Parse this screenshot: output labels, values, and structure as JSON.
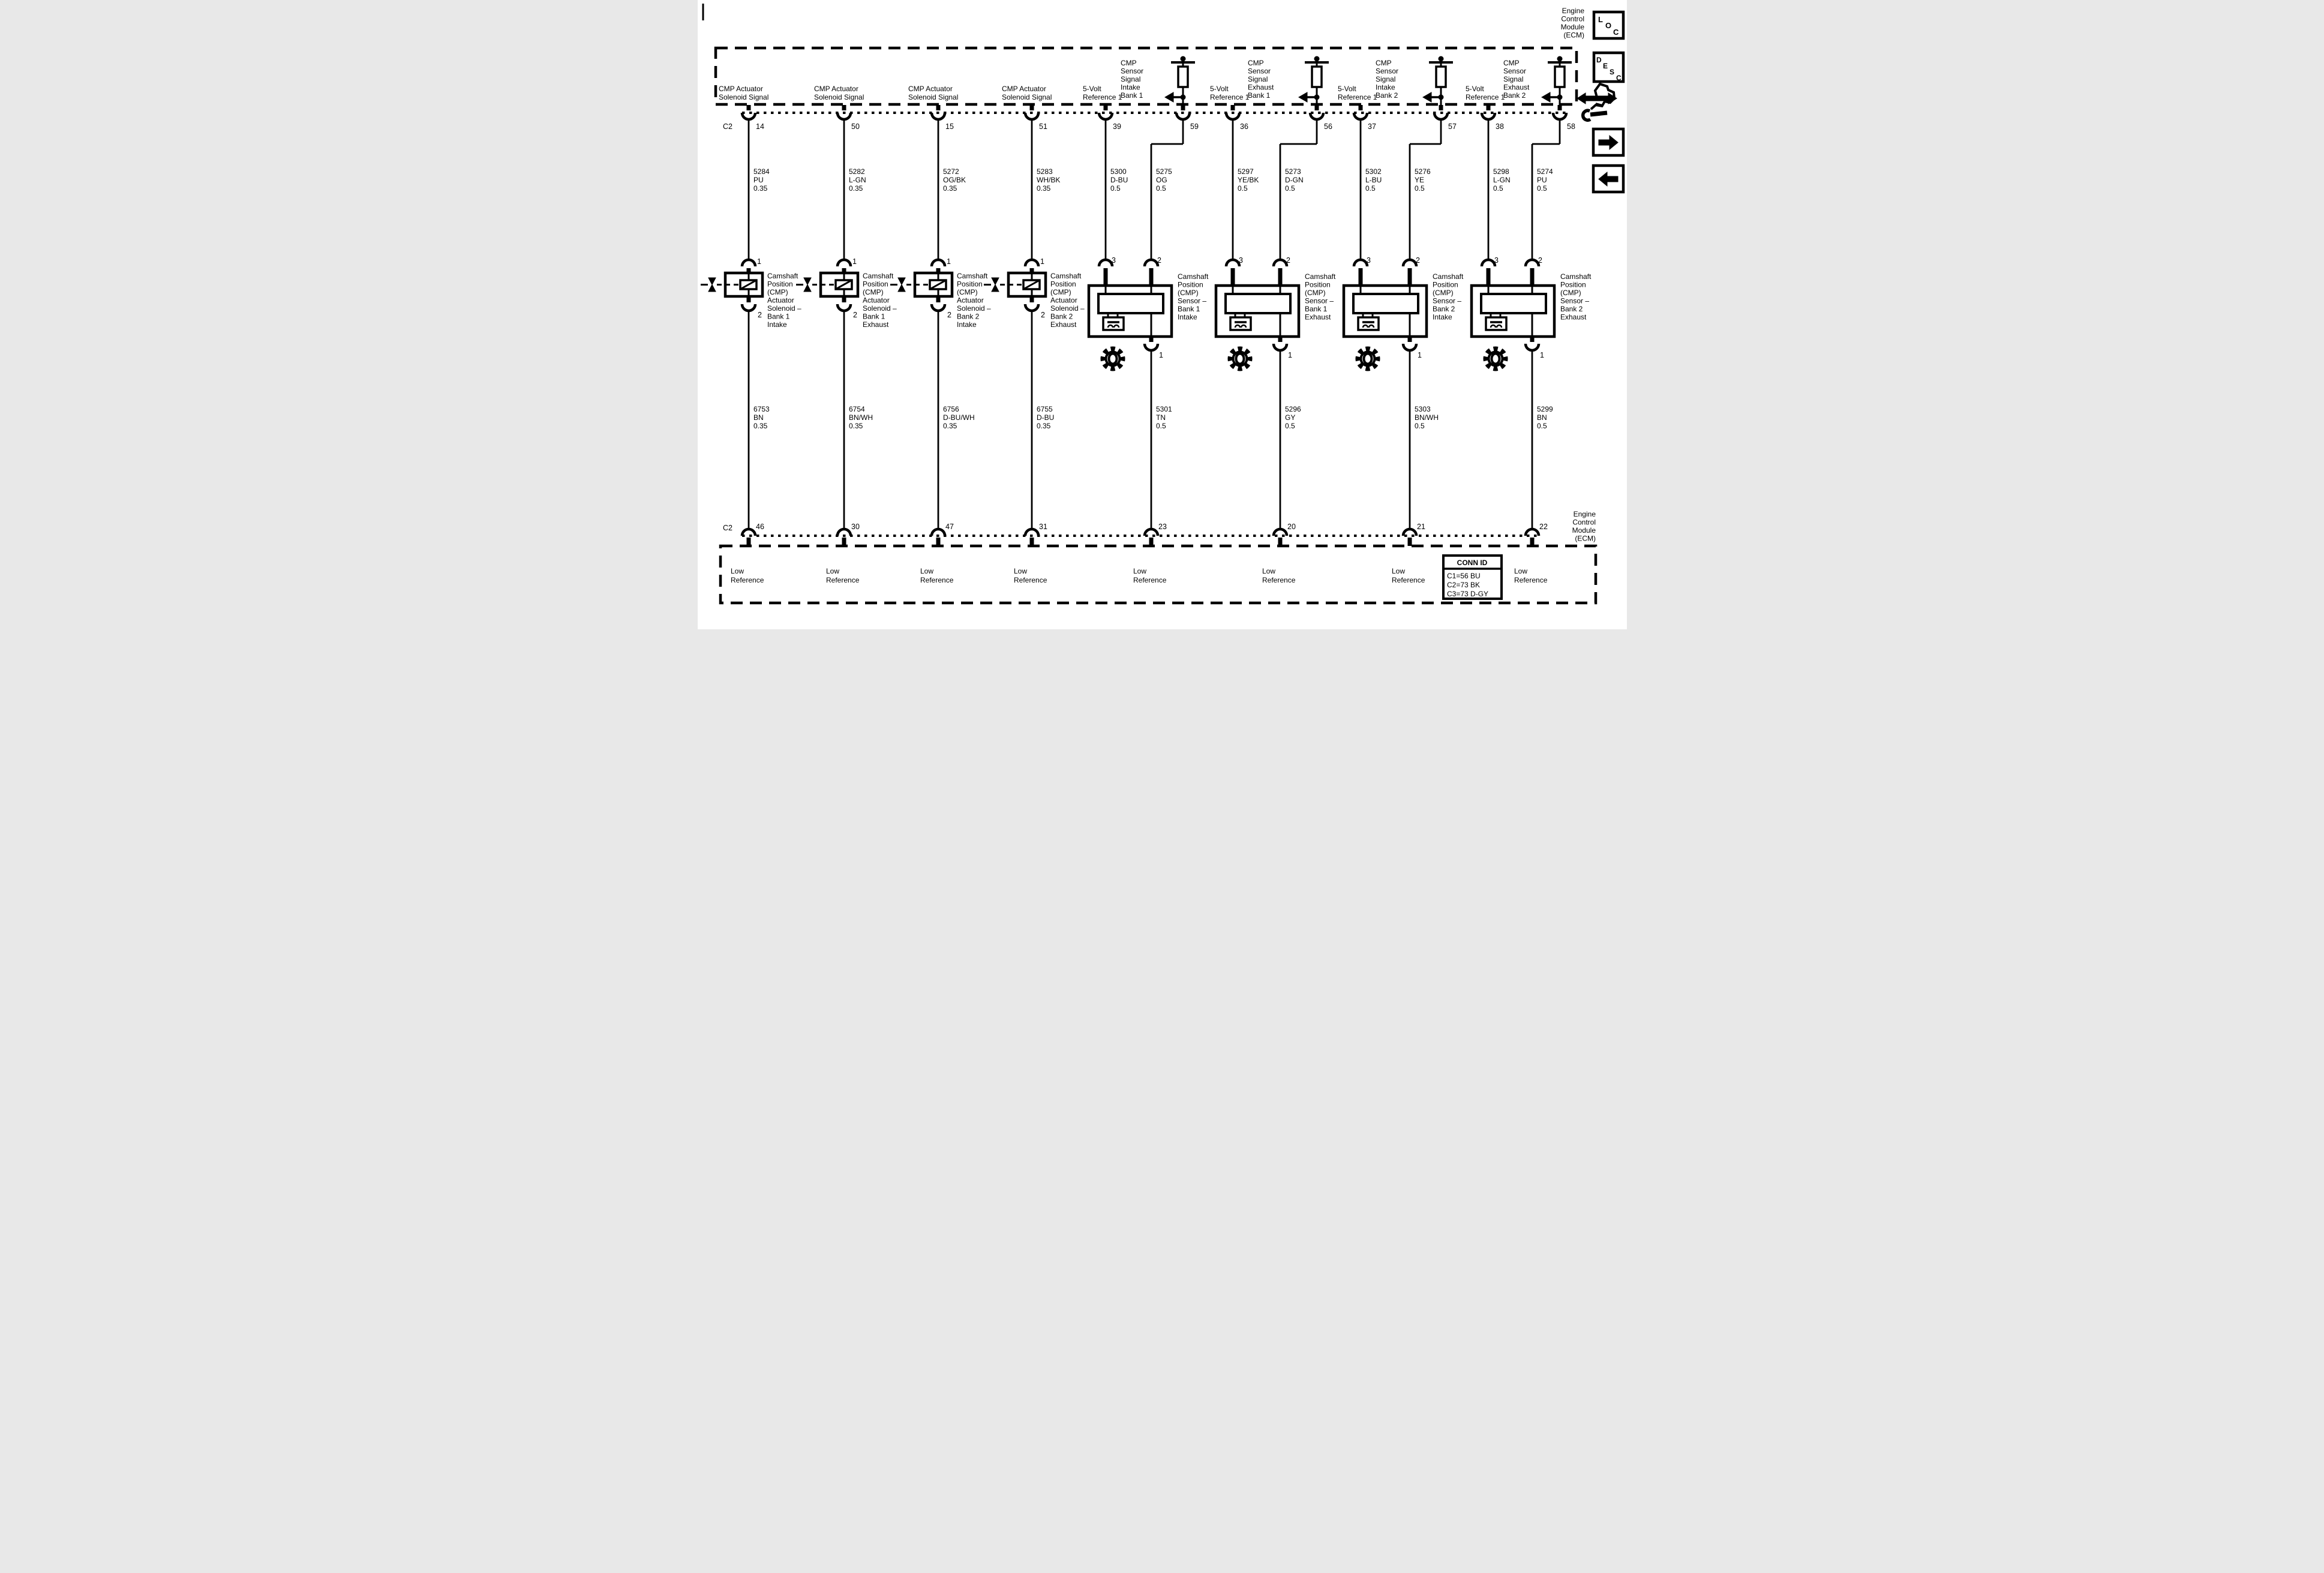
{
  "ecm": {
    "connector_id": "C2",
    "top_label": [
      "Engine",
      "Control",
      "Module",
      "(ECM)"
    ],
    "bottom_label": [
      "Engine",
      "Control",
      "Module",
      "(ECM)"
    ]
  },
  "icons": {
    "loc": [
      "L",
      "O",
      "C"
    ],
    "desc": [
      "D",
      "E",
      "S",
      "C"
    ]
  },
  "conn_id": {
    "title": "CONN ID",
    "rows": [
      "C1=56 BU",
      "C2=73 BK",
      "C3=73 D-GY"
    ]
  },
  "low_reference": [
    "Low",
    "Reference"
  ],
  "actuators": [
    {
      "signal_label": [
        "CMP Actuator",
        "Solenoid Signal"
      ],
      "pin_top": "14",
      "wire_top": [
        "5284",
        "PU",
        "0.35"
      ],
      "dev_pin_top": "1",
      "dev_pin_bottom": "2",
      "device": [
        "Camshaft",
        "Position",
        "(CMP)",
        "Actuator",
        "Solenoid –",
        "Bank 1",
        "Intake"
      ],
      "wire_bottom": [
        "6753",
        "BN",
        "0.35"
      ],
      "pin_bottom": "46"
    },
    {
      "signal_label": [
        "CMP Actuator",
        "Solenoid Signal"
      ],
      "pin_top": "50",
      "wire_top": [
        "5282",
        "L-GN",
        "0.35"
      ],
      "dev_pin_top": "1",
      "dev_pin_bottom": "2",
      "device": [
        "Camshaft",
        "Position",
        "(CMP)",
        "Actuator",
        "Solenoid –",
        "Bank 1",
        "Exhaust"
      ],
      "wire_bottom": [
        "6754",
        "BN/WH",
        "0.35"
      ],
      "pin_bottom": "30"
    },
    {
      "signal_label": [
        "CMP Actuator",
        "Solenoid Signal"
      ],
      "pin_top": "15",
      "wire_top": [
        "5272",
        "OG/BK",
        "0.35"
      ],
      "dev_pin_top": "1",
      "dev_pin_bottom": "2",
      "device": [
        "Camshaft",
        "Position",
        "(CMP)",
        "Actuator",
        "Solenoid –",
        "Bank 2",
        "Intake"
      ],
      "wire_bottom": [
        "6756",
        "D-BU/WH",
        "0.35"
      ],
      "pin_bottom": "47"
    },
    {
      "signal_label": [
        "CMP Actuator",
        "Solenoid Signal"
      ],
      "pin_top": "51",
      "wire_top": [
        "5283",
        "WH/BK",
        "0.35"
      ],
      "dev_pin_top": "1",
      "dev_pin_bottom": "2",
      "device": [
        "Camshaft",
        "Position",
        "(CMP)",
        "Actuator",
        "Solenoid –",
        "Bank 2",
        "Exhaust"
      ],
      "wire_bottom": [
        "6755",
        "D-BU",
        "0.35"
      ],
      "pin_bottom": "31"
    }
  ],
  "sensors": [
    {
      "ref_label": [
        "5-Volt",
        "Reference 1"
      ],
      "sig_label": [
        "CMP",
        "Sensor",
        "Signal",
        "Intake",
        "Bank 1"
      ],
      "pin_ref": "39",
      "pin_sig": "59",
      "wire_ref": [
        "5300",
        "D-BU",
        "0.5"
      ],
      "wire_sig": [
        "5275",
        "OG",
        "0.5"
      ],
      "dev_pin_ref": "3",
      "dev_pin_sig": "2",
      "dev_pin_low": "1",
      "device": [
        "Camshaft",
        "Position",
        "(CMP)",
        "Sensor –",
        "Bank 1",
        "Intake"
      ],
      "wire_low": [
        "5301",
        "TN",
        "0.5"
      ],
      "pin_low": "23"
    },
    {
      "ref_label": [
        "5-Volt",
        "Reference 1"
      ],
      "sig_label": [
        "CMP",
        "Sensor",
        "Signal",
        "Exhaust",
        "Bank 1"
      ],
      "pin_ref": "36",
      "pin_sig": "56",
      "wire_ref": [
        "5297",
        "YE/BK",
        "0.5"
      ],
      "wire_sig": [
        "5273",
        "D-GN",
        "0.5"
      ],
      "dev_pin_ref": "3",
      "dev_pin_sig": "2",
      "dev_pin_low": "1",
      "device": [
        "Camshaft",
        "Position",
        "(CMP)",
        "Sensor –",
        "Bank 1",
        "Exhaust"
      ],
      "wire_low": [
        "5296",
        "GY",
        "0.5"
      ],
      "pin_low": "20"
    },
    {
      "ref_label": [
        "5-Volt",
        "Reference 1"
      ],
      "sig_label": [
        "CMP",
        "Sensor",
        "Signal",
        "Intake",
        "Bank 2"
      ],
      "pin_ref": "37",
      "pin_sig": "57",
      "wire_ref": [
        "5302",
        "L-BU",
        "0.5"
      ],
      "wire_sig": [
        "5276",
        "YE",
        "0.5"
      ],
      "dev_pin_ref": "3",
      "dev_pin_sig": "2",
      "dev_pin_low": "1",
      "device": [
        "Camshaft",
        "Position",
        "(CMP)",
        "Sensor –",
        "Bank 2",
        "Intake"
      ],
      "wire_low": [
        "5303",
        "BN/WH",
        "0.5"
      ],
      "pin_low": "21"
    },
    {
      "ref_label": [
        "5-Volt",
        "Reference 1"
      ],
      "sig_label": [
        "CMP",
        "Sensor",
        "Signal",
        "Exhaust",
        "Bank 2"
      ],
      "pin_ref": "38",
      "pin_sig": "58",
      "wire_ref": [
        "5298",
        "L-GN",
        "0.5"
      ],
      "wire_sig": [
        "5274",
        "PU",
        "0.5"
      ],
      "dev_pin_ref": "3",
      "dev_pin_sig": "2",
      "dev_pin_low": "1",
      "device": [
        "Camshaft",
        "Position",
        "(CMP)",
        "Sensor –",
        "Bank 2",
        "Exhaust"
      ],
      "wire_low": [
        "5299",
        "BN",
        "0.5"
      ],
      "pin_low": "22"
    }
  ]
}
